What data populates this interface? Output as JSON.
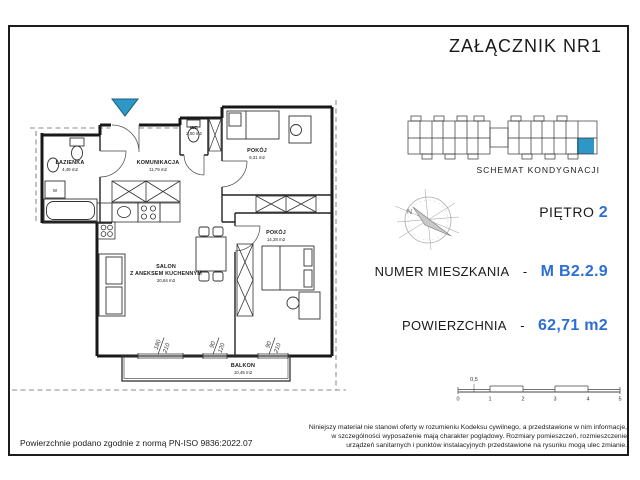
{
  "page": {
    "title": "ZAŁĄCZNIK NR1",
    "footer_note": "Powierzchnie podano zgodnie z normą PN-ISO 9836:2022.07",
    "disclaimer": [
      "Niniejszy materiał nie stanowi oferty w rozumieniu Kodeksu cywilnego, a przedstawione w nim informacje,",
      "w szczególności wyposażenie mają charakter poglądowy. Rozmiary pomieszczeń, rozmieszczenie",
      "urządzeń sanitarnych i punktów instalacyjnych przedstawione na rysunku mogą ulec zmianie."
    ]
  },
  "info": {
    "schematic_caption": "SCHEMAT KONDYGNACJI",
    "floor_label": "PIĘTRO",
    "floor_value": "2",
    "apartment_label": "NUMER MIESZKANIA",
    "separator": "-",
    "apartment_value": "M B2.2.9",
    "area_label": "POWIERZCHNIA",
    "area_value": "62,71 m2"
  },
  "plan": {
    "rooms": {
      "lazienka": {
        "name": "ŁAZIENKA",
        "area": "4,49 m2"
      },
      "komunikacja": {
        "name": "KOMUNIKACJA",
        "area": "11,79 m2"
      },
      "wc": {
        "name": "WC",
        "area": "2,00 m2"
      },
      "pokoj1": {
        "name": "POKÓJ",
        "area": "9,31 m2"
      },
      "pokoj2": {
        "name": "POKÓJ",
        "area": "14,28 m2"
      },
      "salon": {
        "name": "SALON",
        "name2": "Z ANEKSEM KUCHENNYM",
        "area": "20,84 m2"
      },
      "balkon": {
        "name": "BALKON",
        "area": "10,45 m2"
      }
    },
    "window_dims": [
      {
        "w": "180",
        "h": "210"
      },
      {
        "w": "90",
        "h": "120"
      },
      {
        "w": "90",
        "h": "210"
      }
    ],
    "washer_label": "W",
    "compass_north": "N"
  },
  "scalebar": {
    "ticks": [
      "0",
      "1",
      "2",
      "3",
      "4",
      "5"
    ],
    "half": "0,5"
  },
  "colors": {
    "accent_text": "#2b6fd6",
    "marker_blue": "#2f97c5"
  }
}
